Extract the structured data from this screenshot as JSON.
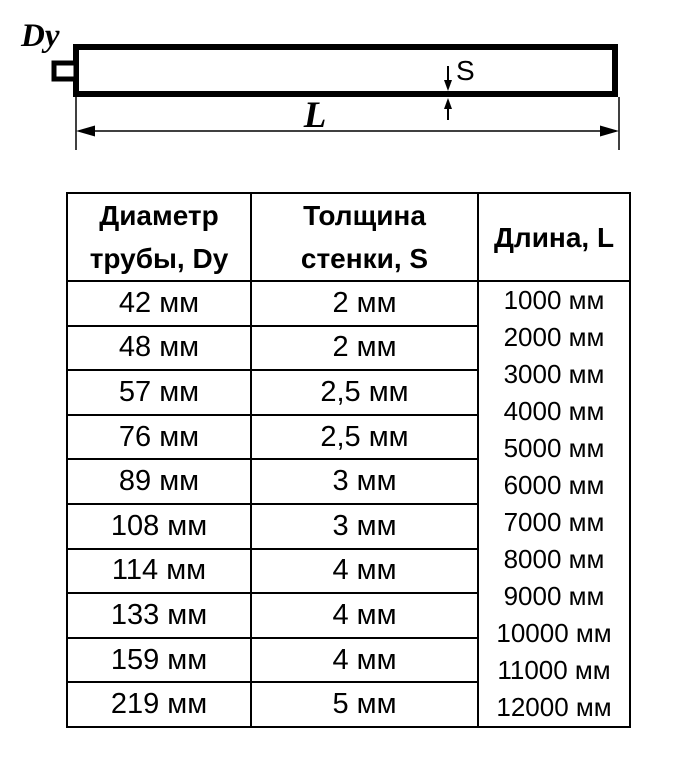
{
  "diagram": {
    "pipe_diameter_label": "Dy",
    "wall_thickness_label": "S",
    "length_label": "L"
  },
  "table": {
    "headers": [
      {
        "lines": [
          "Диаметр",
          "трубы, Dy"
        ]
      },
      {
        "lines": [
          "Толщина",
          "стенки, S"
        ]
      },
      {
        "lines": [
          "Длина, L"
        ]
      }
    ],
    "rows": [
      {
        "diameter": "42 мм",
        "thickness": "2 мм"
      },
      {
        "diameter": "48 мм",
        "thickness": "2 мм"
      },
      {
        "diameter": "57 мм",
        "thickness": "2,5 мм"
      },
      {
        "diameter": "76 мм",
        "thickness": "2,5 мм"
      },
      {
        "diameter": "89 мм",
        "thickness": "3 мм"
      },
      {
        "diameter": "108 мм",
        "thickness": "3 мм"
      },
      {
        "diameter": "114 мм",
        "thickness": "4 мм"
      },
      {
        "diameter": "133 мм",
        "thickness": "4 мм"
      },
      {
        "diameter": "159 мм",
        "thickness": "4 мм"
      },
      {
        "diameter": "219 мм",
        "thickness": "5 мм"
      }
    ],
    "lengths": [
      "1000 мм",
      "2000 мм",
      "3000 мм",
      "4000 мм",
      "5000 мм",
      "6000 мм",
      "7000 мм",
      "8000 мм",
      "9000 мм",
      "10000 мм",
      "11000 мм",
      "12000 мм"
    ]
  },
  "colors": {
    "ink": "#000000",
    "background": "#ffffff"
  }
}
